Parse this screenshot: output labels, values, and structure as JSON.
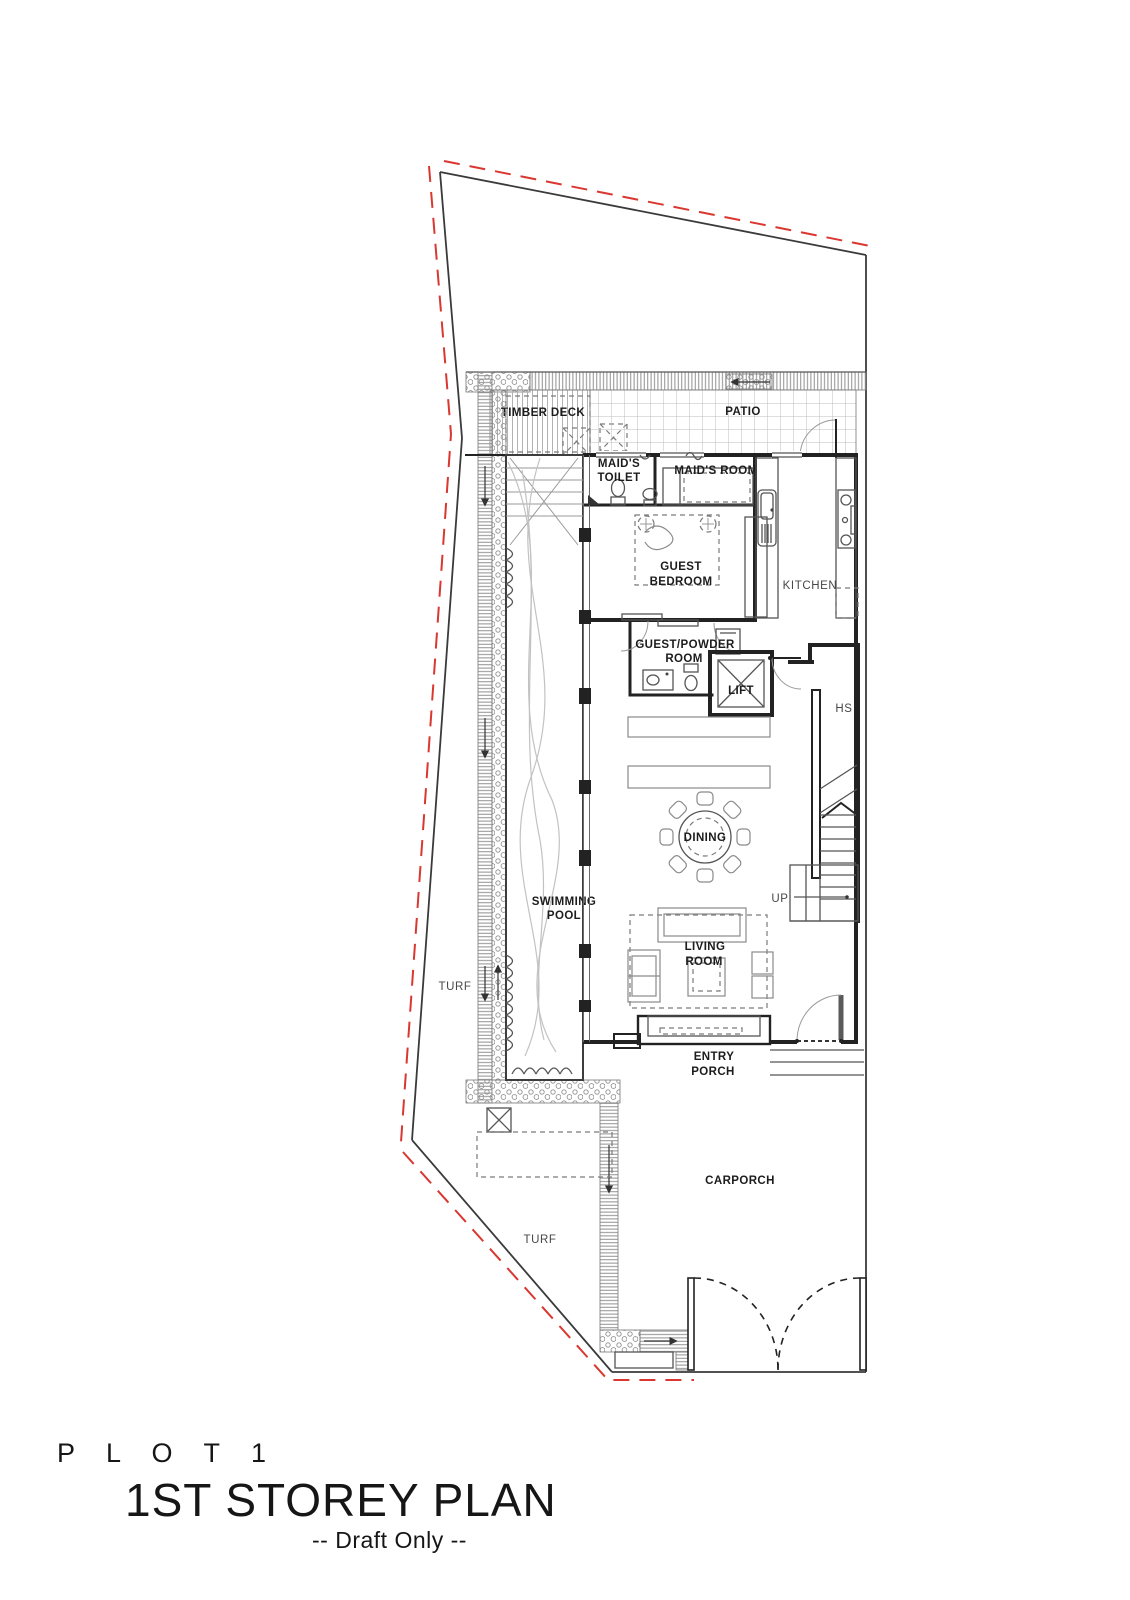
{
  "colors": {
    "wall": "#222222",
    "line": "#555555",
    "light": "#9a9a9a",
    "furniture": "#8a8a8a",
    "boundary_red": "#d9372f",
    "water": "#c2c2c2",
    "text": "#1c1c1c",
    "text_light": "#474747"
  },
  "labels": {
    "timber_deck": "TIMBER DECK",
    "patio": "PATIO",
    "maids_toilet_1": "MAID'S",
    "maids_toilet_2": "TOILET",
    "maids_room": "MAID'S ROOM",
    "guest_bedroom_1": "GUEST",
    "guest_bedroom_2": "BEDROOM",
    "kitchen": "KITCHEN",
    "powder_1": "GUEST/POWDER",
    "powder_2": "ROOM",
    "lift": "LIFT",
    "hs": "HS",
    "dining": "DINING",
    "up": "UP",
    "pool_1": "SWIMMING",
    "pool_2": "POOL",
    "living_1": "LIVING",
    "living_2": "ROOM",
    "turf_left": "TURF",
    "entry_porch_1": "ENTRY",
    "entry_porch_2": "PORCH",
    "carporch": "CARPORCH",
    "turf_bottom": "TURF"
  },
  "title": {
    "plot": "P L O T  1",
    "main": "1ST STOREY PLAN",
    "subtitle": "-- Draft Only --"
  }
}
